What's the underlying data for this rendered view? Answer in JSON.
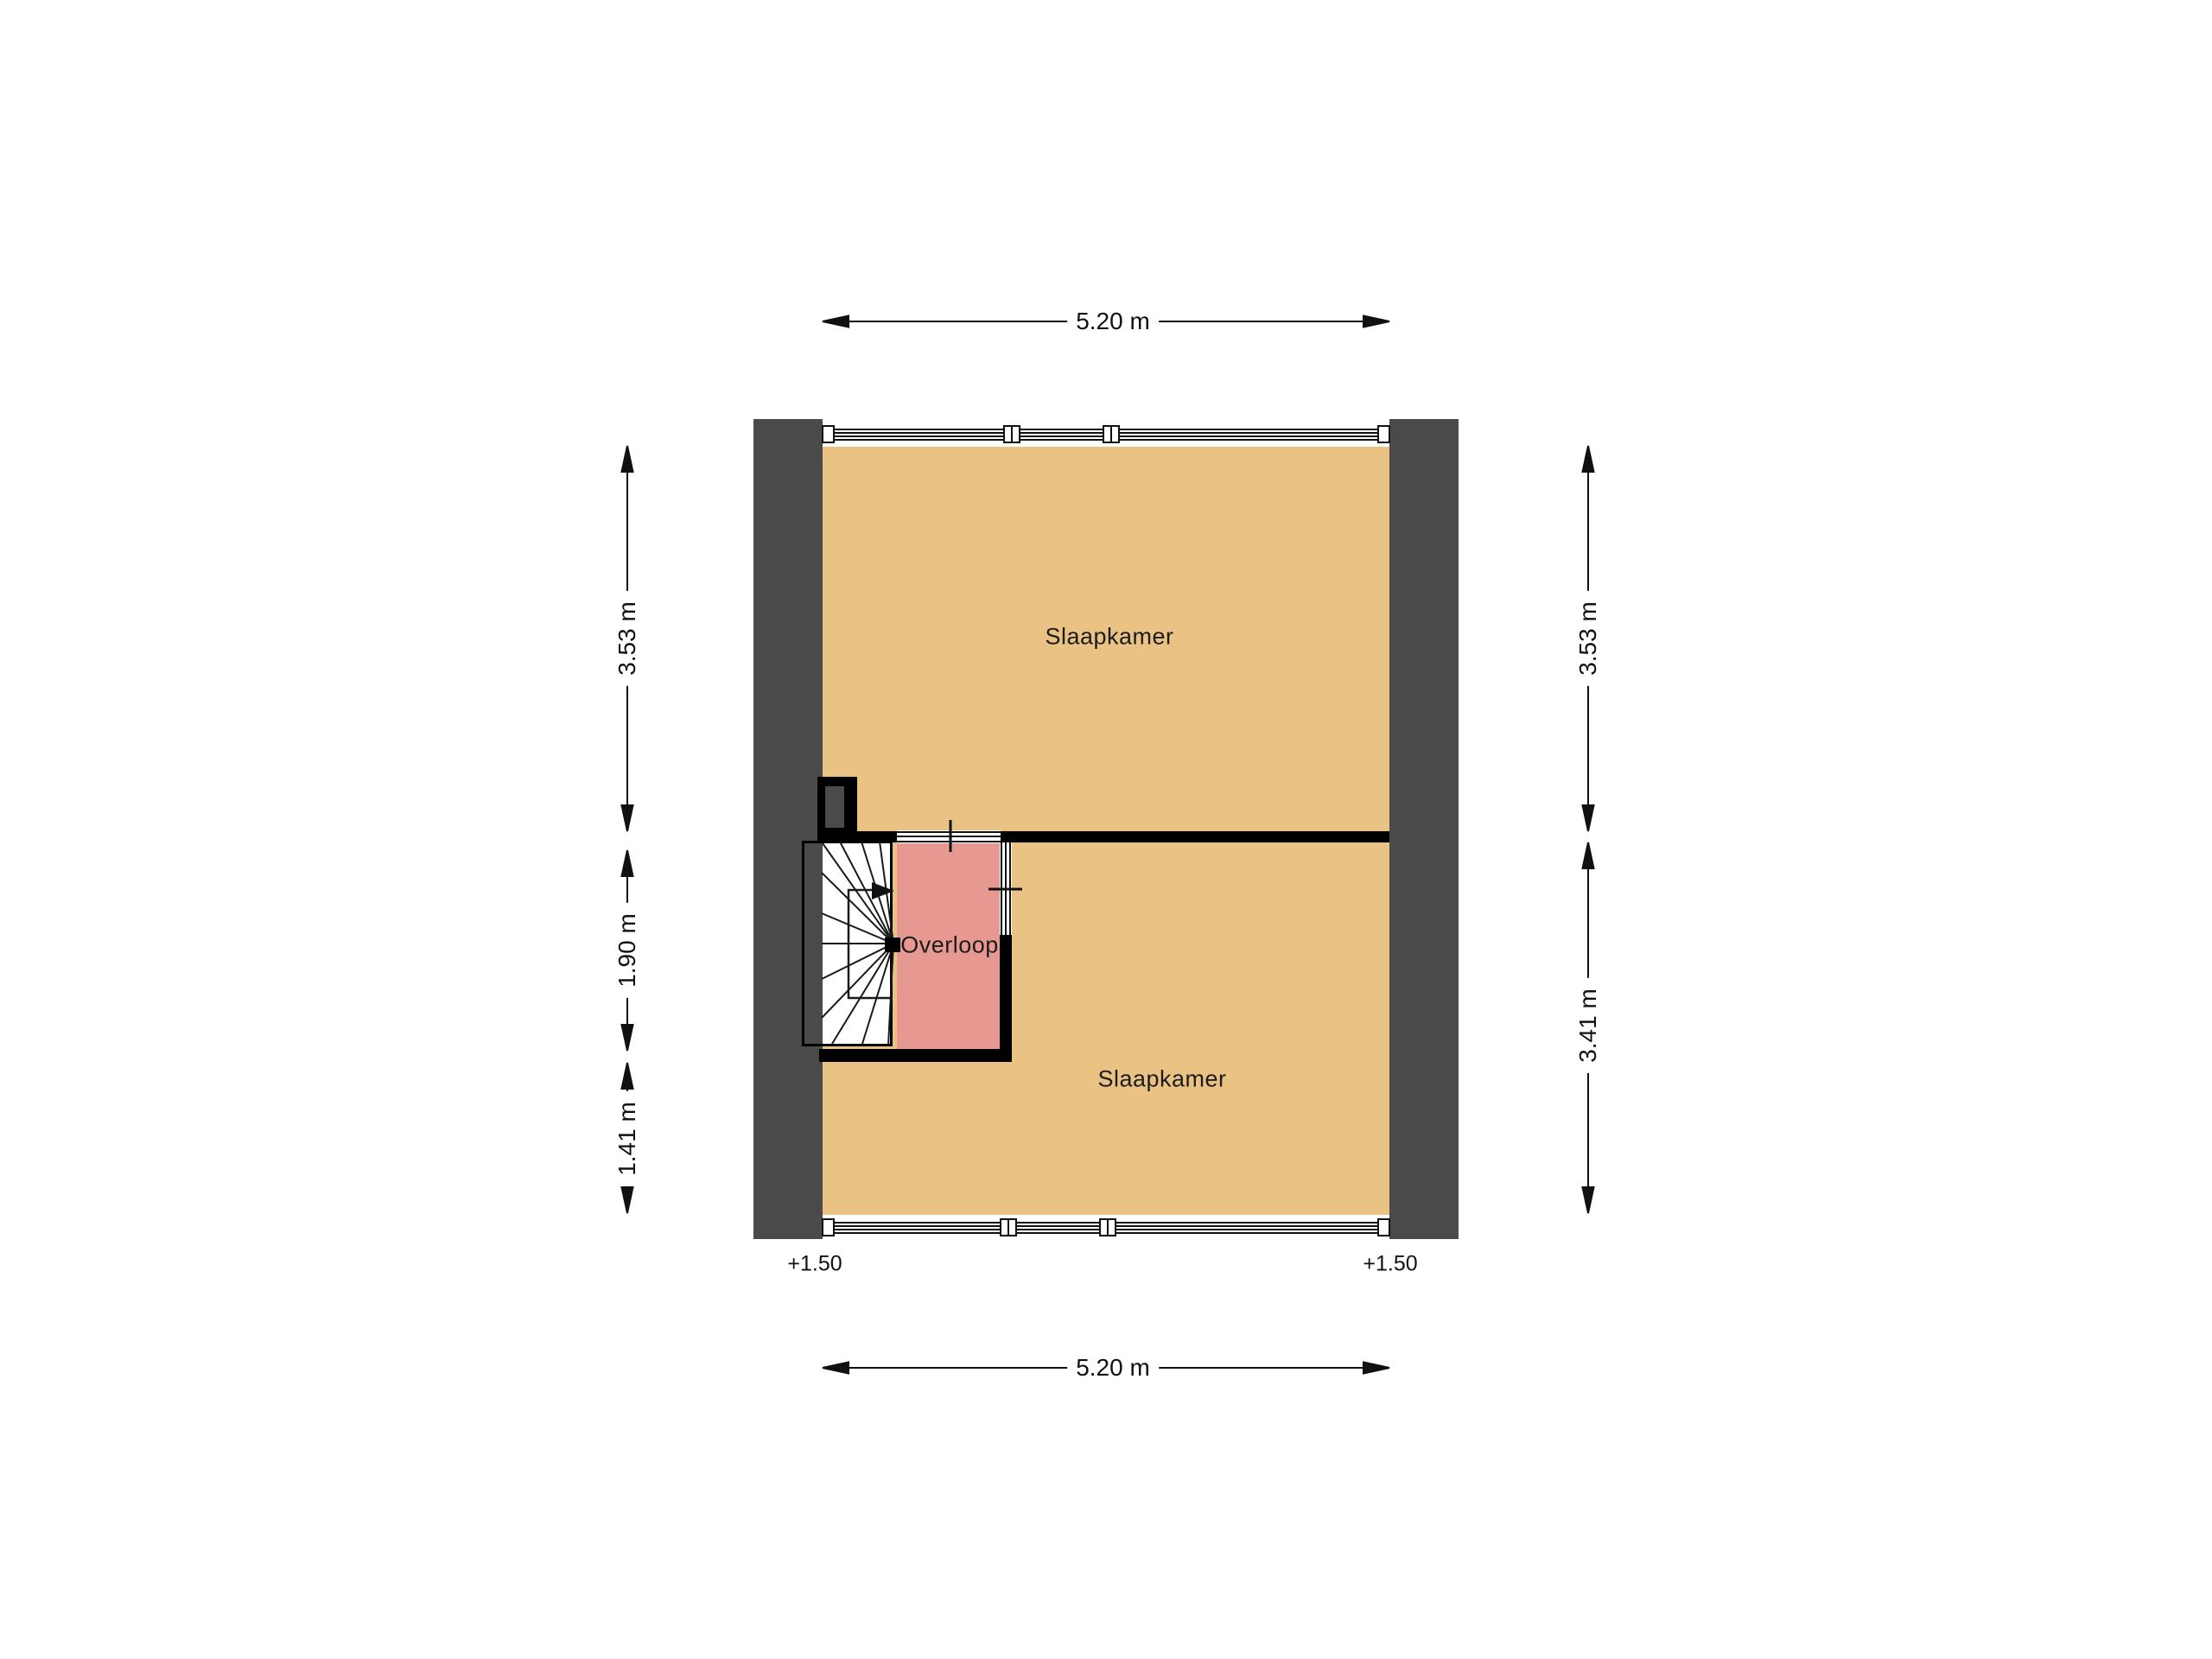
{
  "floorplan": {
    "rooms": {
      "bedroom_top": {
        "label": "Slaapkamer",
        "floor_color": "#EAC283"
      },
      "bedroom_bottom": {
        "label": "Slaapkamer",
        "floor_color": "#EAC283"
      },
      "landing": {
        "label": "Overloop",
        "floor_color": "#E79890"
      }
    },
    "dimensions": {
      "top": "5.20 m",
      "bottom": "5.20 m",
      "left_upper": "3.53 m",
      "left_middle": "1.90 m",
      "left_lower": "1.41 m",
      "right_upper": "3.53 m",
      "right_lower": "3.41 m"
    },
    "levels": {
      "left": "+1.50",
      "right": "+1.50"
    },
    "colors": {
      "wall_dark_gray": "#4A4A4A",
      "wall_black": "#000000",
      "floor_tan": "#EAC283",
      "landing_pink": "#E79890",
      "line_black": "#111111",
      "background": "#FFFFFF"
    }
  }
}
